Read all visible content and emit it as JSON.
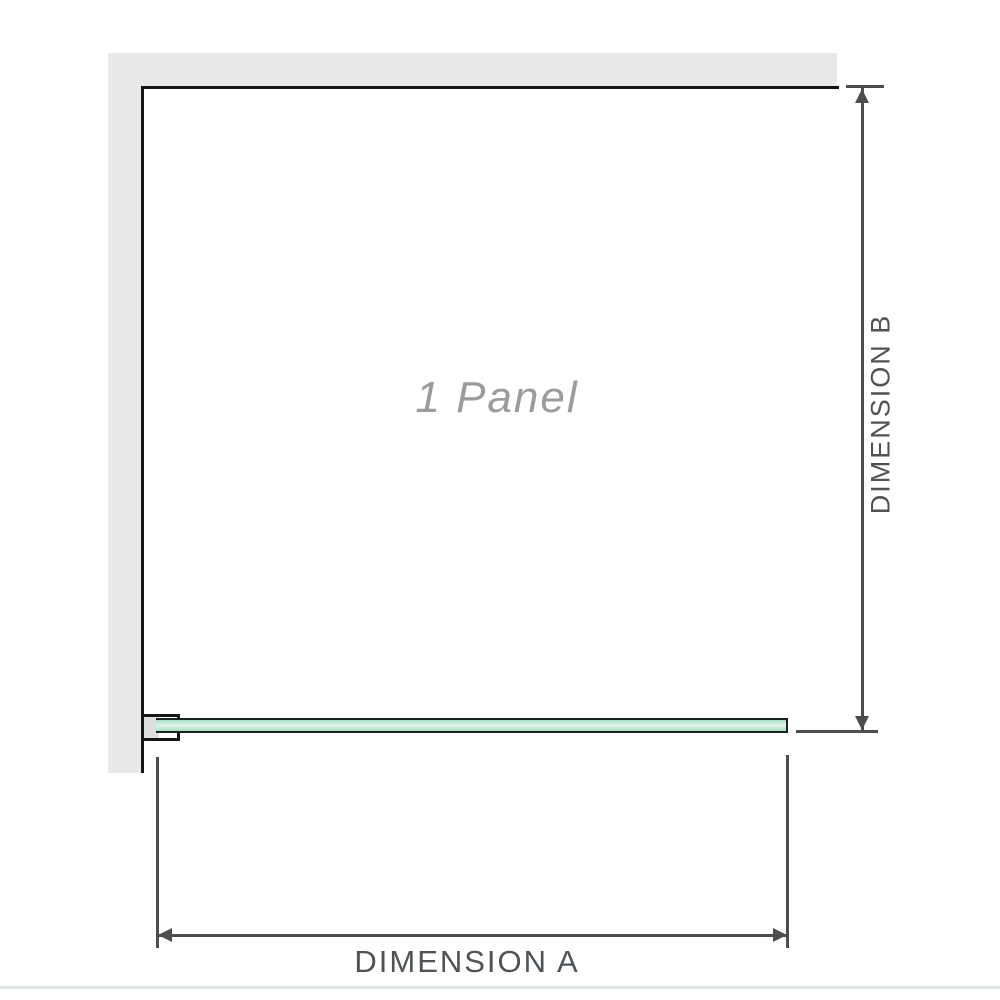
{
  "diagram": {
    "panel_label": "1 Panel",
    "dimension_a_label": "DIMENSION A",
    "dimension_b_label": "DIMENSION B"
  },
  "colors": {
    "wall": "#e9e9e9",
    "outline": "#151515",
    "dim": "#4d4d4d",
    "dim_text": "#4e5357",
    "panel_text": "#9b9b9b",
    "glass_fill": "#a7dec1",
    "glass_light": "#e2f4ea",
    "glass_border": "#18231b",
    "bracket_fill": "#dedede",
    "divider": "#dfe4e6"
  }
}
